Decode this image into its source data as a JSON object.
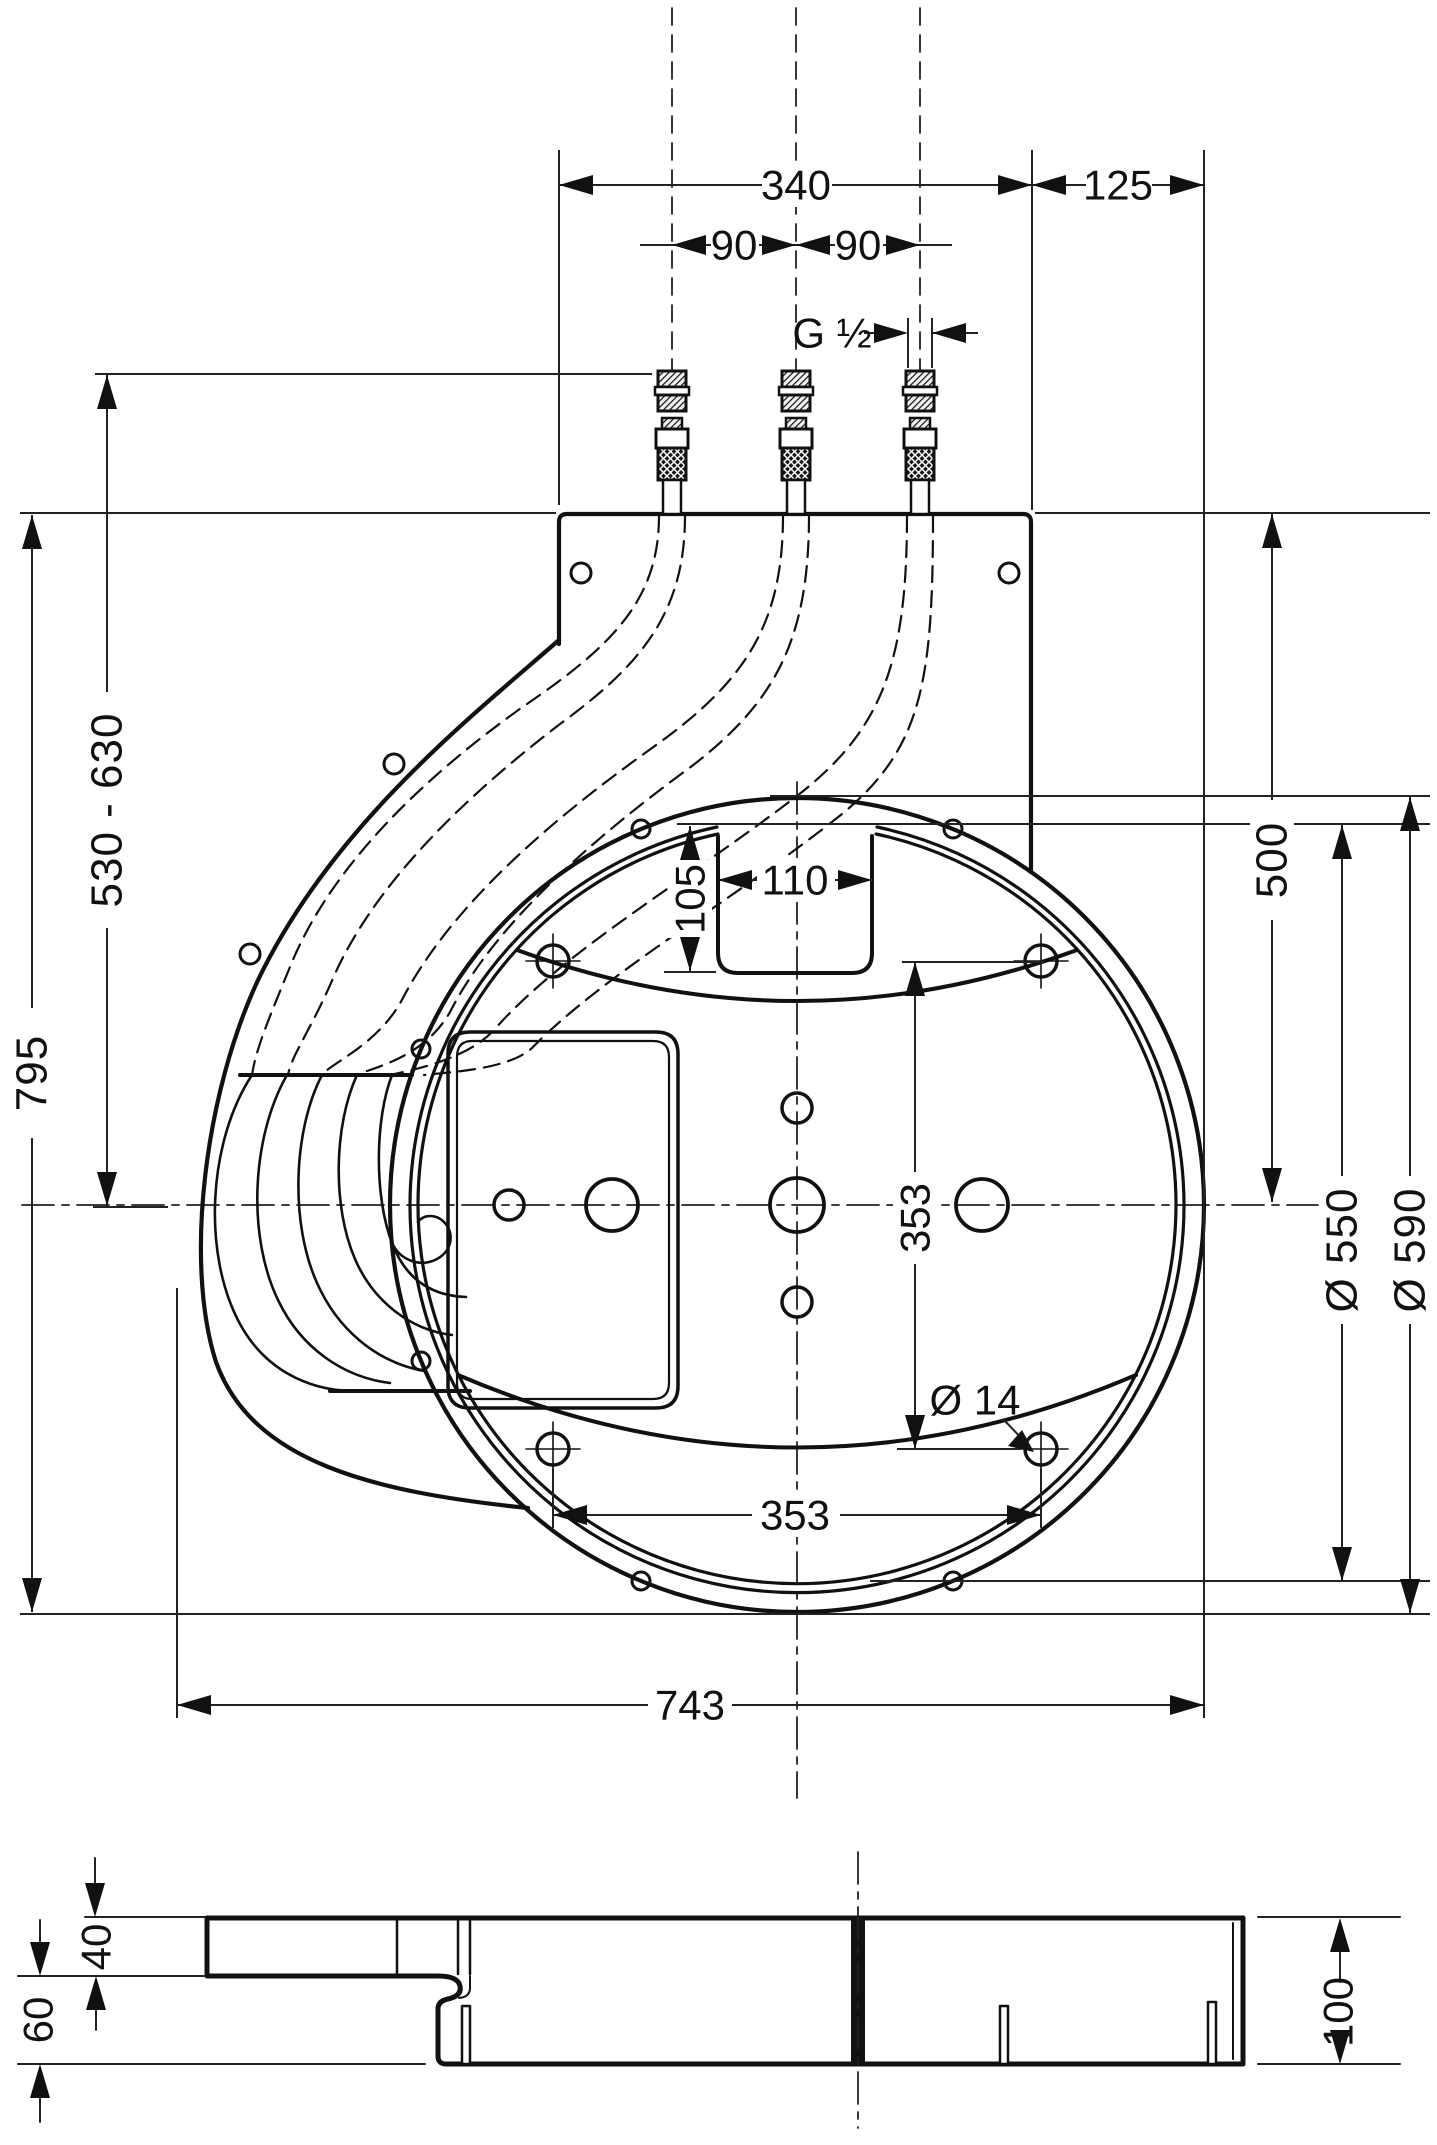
{
  "drawing": {
    "type": "installation-dimension-drawing",
    "colors": {
      "line": "#111111",
      "dim": "#222222",
      "background": "#ffffff"
    },
    "labels": {
      "top_width": "340",
      "top_offset": "125",
      "port_left": "90",
      "port_right": "90",
      "thread": "G ½",
      "mount_height": "530 - 630",
      "total_height": "795",
      "center_height": "500",
      "dia_inner": "Ø 550",
      "dia_outer": "Ø 590",
      "cutout_w": "110",
      "cutout_d": "105",
      "bolt_v": "353",
      "bolt_h": "353",
      "bolt_dia": "Ø 14",
      "total_width": "743",
      "sec_plate": "40",
      "sec_recess": "60",
      "sec_depth": "100"
    }
  }
}
